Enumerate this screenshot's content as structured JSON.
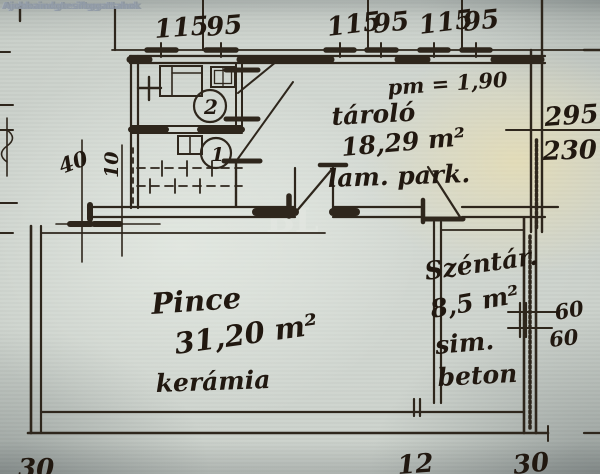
{
  "watermark": "Ajobbaindgtesiftggattahok",
  "center_mark": "BL",
  "top_dims": {
    "g1a": "115",
    "g1b": "95",
    "g2a": "115",
    "g2b": "95",
    "g3a": "115",
    "g3b": "95"
  },
  "right_dims": {
    "d295": "295",
    "d230": "230",
    "d60a": "60",
    "d60b": "60"
  },
  "left_dims": {
    "d40": "40",
    "d10": "10"
  },
  "bottom_dims": {
    "b_left": "30",
    "b_mid": "12",
    "b_right": "30"
  },
  "rooms": {
    "tarolo": {
      "note": "pm = 1,90",
      "name": "tároló",
      "area": "18,29 m²",
      "floor": "lam. park."
    },
    "pince": {
      "name": "Pince",
      "area": "31,20 m²",
      "floor": "kerámia"
    },
    "szentar": {
      "name": "Széntár.",
      "area": "8,5 m²",
      "floor1": "sim.",
      "floor2": "beton"
    }
  },
  "fixtures": {
    "num1": "1",
    "num2": "2"
  }
}
